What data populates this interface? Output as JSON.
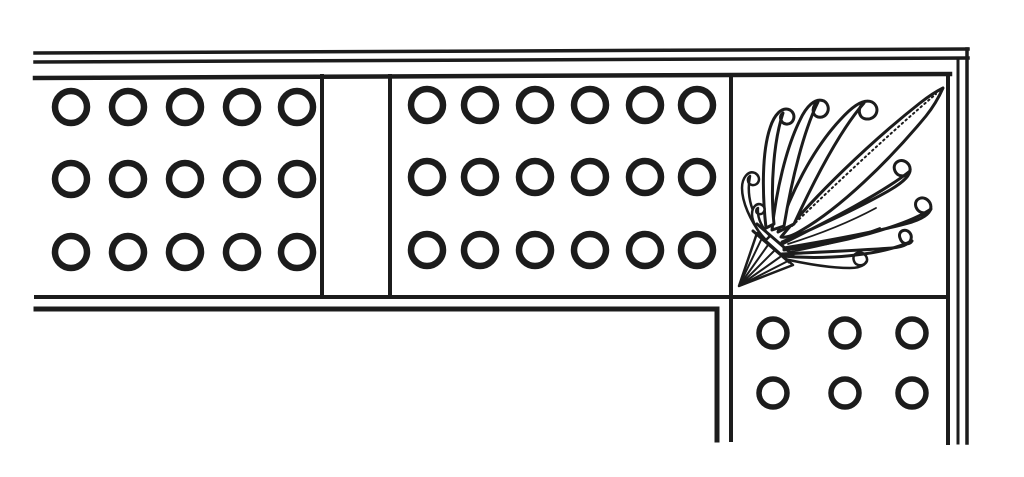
{
  "canvas": {
    "width": 1024,
    "height": 477,
    "paper_color": "#ffffff",
    "ink_color": "#1c1c1c"
  },
  "figure": {
    "kind": "engraved ornamental border, corner section",
    "description": "L-shaped corner of a frame border: horizontal frieze of panels studded with rings, a corner square filled with a palmette (anthemion) leaf ornament, and a vertical band of rings descending below the corner. Framed by double rule lines; band ends are cut off open.",
    "panels": {
      "left_ring_panel": {
        "rows": 3,
        "cols": 5
      },
      "spacer_panel": {
        "content": "blank"
      },
      "middle_ring_panel": {
        "rows": 3,
        "cols": 6
      },
      "corner_panel": {
        "ornament": "palmette"
      },
      "vertical_band": {
        "rows": 2,
        "cols": 3
      }
    }
  },
  "ring_grids": [
    {
      "name": "left-panel-rings",
      "rows": [
        107,
        179,
        252
      ],
      "cols": [
        71,
        128,
        185,
        242,
        297
      ],
      "r": 16,
      "stroke_w": 6.5
    },
    {
      "name": "middle-panel-rings",
      "rows": [
        105,
        177,
        250
      ],
      "cols": [
        427,
        480,
        535,
        590,
        645,
        697
      ],
      "r": 16,
      "stroke_w": 6.5
    },
    {
      "name": "vertical-band-rings",
      "rows": [
        333,
        393
      ],
      "cols": [
        773,
        845,
        912
      ],
      "r": 14,
      "stroke_w": 5.5
    }
  ],
  "border_lines": [
    {
      "name": "top-rule-outer-a",
      "x1": 35,
      "y1": 53,
      "x2": 968,
      "y2": 49,
      "w": 3.5
    },
    {
      "name": "top-rule-outer-b",
      "x1": 35,
      "y1": 62,
      "x2": 968,
      "y2": 58,
      "w": 3.5
    },
    {
      "name": "top-rule-inner",
      "x1": 35,
      "y1": 78,
      "x2": 950,
      "y2": 74,
      "w": 4.5
    },
    {
      "name": "right-rule-outer-a",
      "x1": 967,
      "y1": 49,
      "x2": 967,
      "y2": 443,
      "w": 3.5
    },
    {
      "name": "right-rule-outer-b",
      "x1": 958,
      "y1": 58,
      "x2": 958,
      "y2": 443,
      "w": 3
    },
    {
      "name": "right-rule-inner",
      "x1": 948,
      "y1": 74,
      "x2": 948,
      "y2": 443,
      "w": 4
    },
    {
      "name": "frieze-bottom-upper-rule",
      "x1": 36,
      "y1": 297,
      "x2": 948,
      "y2": 297,
      "w": 4
    },
    {
      "name": "panel-divider-left",
      "x1": 322,
      "y1": 76,
      "x2": 322,
      "y2": 297,
      "w": 4
    },
    {
      "name": "panel-divider-right",
      "x1": 390,
      "y1": 76,
      "x2": 390,
      "y2": 297,
      "w": 4
    },
    {
      "name": "corner-square-left-edge",
      "x1": 731,
      "y1": 76,
      "x2": 731,
      "y2": 440,
      "w": 4
    }
  ],
  "border_polylines": [
    {
      "name": "frieze-bottom-lower-rule-and-band-left-edge",
      "points": [
        [
          36,
          309
        ],
        [
          717,
          309
        ],
        [
          717,
          440
        ]
      ],
      "w": 5
    }
  ],
  "palmette": {
    "name": "palmette-ornament",
    "paths": [
      {
        "d": "M782,242 C820,226 862,206 890,190 C902,183 914,174 909,165 C903,156 891,162 895,171 C898,178 908,177 910,171 C884,192 830,220 782,244 Z",
        "w": 3,
        "fill": "#ffffff"
      },
      {
        "d": "M784,248 C832,240 884,230 912,222 C924,218 934,212 930,203 C925,194 913,198 916,207 C919,215 929,214 931,209 C906,226 840,244 784,250 Z",
        "w": 3,
        "fill": "#ffffff"
      },
      {
        "d": "M782,254 C824,252 866,250 892,248 C904,247 913,243 911,235 C908,227 897,230 900,238 C902,245 910,245 912,241 C880,256 824,260 782,256 Z",
        "w": 3,
        "fill": "#ffffff"
      },
      {
        "d": "M780,258 C806,264 832,268 850,268 C862,268 870,263 866,256 C861,249 851,253 854,261 C856,267 864,266 866,262",
        "w": 2.5,
        "fill": "none"
      },
      {
        "d": "M788,244 C820,234 850,222 876,208",
        "w": 1.8,
        "fill": "none"
      },
      {
        "d": "M790,252 C822,246 854,238 880,228",
        "w": 1.8,
        "fill": "none"
      },
      {
        "d": "M781,237 C815,196 868,144 920,103 C929,96 937,91 943,88 C939,97 934,106 926,116 C888,162 840,208 802,230 C794,235 786,238 781,237 Z",
        "w": 3,
        "fill": "#ffffff"
      },
      {
        "d": "M792,226 C836,184 890,133 936,94",
        "w": 2,
        "fill": "none",
        "dash": "1.5,3.5"
      },
      {
        "d": "M778,232 C790,195 812,150 840,120 C850,109 862,98 872,102 C881,107 877,120 866,119 C858,118 857,107 864,103 C842,128 818,172 794,224 Z",
        "w": 3,
        "fill": "#ffffff"
      },
      {
        "d": "M772,230 C776,192 786,148 800,120 C806,107 815,97 824,101 C832,106 828,119 818,117 C811,115 812,105 818,102 C804,130 792,178 784,226 Z",
        "w": 3,
        "fill": "#ffffff"
      },
      {
        "d": "M766,228 C762,192 762,152 770,128 C774,115 782,106 790,110 C797,114 794,125 786,124 C780,123 779,116 783,113 C774,140 770,186 774,224 Z",
        "w": 3,
        "fill": "#ffffff"
      },
      {
        "d": "M762,236 C750,220 742,202 742,188 C742,178 748,170 755,173 C762,177 759,186 752,185 C747,184 747,178 750,176 C746,196 752,216 766,232 Z",
        "w": 2.5,
        "fill": "#ffffff"
      },
      {
        "d": "M766,240 C758,232 752,222 752,214 C752,207 757,202 762,205 C767,208 764,215 759,214 C755,213 756,209 758,208 C757,218 762,228 770,236 Z",
        "w": 2.5,
        "fill": "#ffffff"
      },
      {
        "d": "M739,286 L757,233 L793,265 Z",
        "w": 2.5,
        "fill": "#ffffff"
      },
      {
        "d": "M739,286 L762,238",
        "w": 2,
        "fill": "none"
      },
      {
        "d": "M739,286 L768,245",
        "w": 2,
        "fill": "none"
      },
      {
        "d": "M739,286 L774,251",
        "w": 2,
        "fill": "none"
      },
      {
        "d": "M739,286 L780,257",
        "w": 2,
        "fill": "none"
      },
      {
        "d": "M739,286 L786,262",
        "w": 2,
        "fill": "none"
      },
      {
        "d": "M753,231 L789,262",
        "w": 3,
        "fill": "none"
      },
      {
        "d": "M757,224 L793,255",
        "w": 3,
        "fill": "none"
      }
    ]
  }
}
